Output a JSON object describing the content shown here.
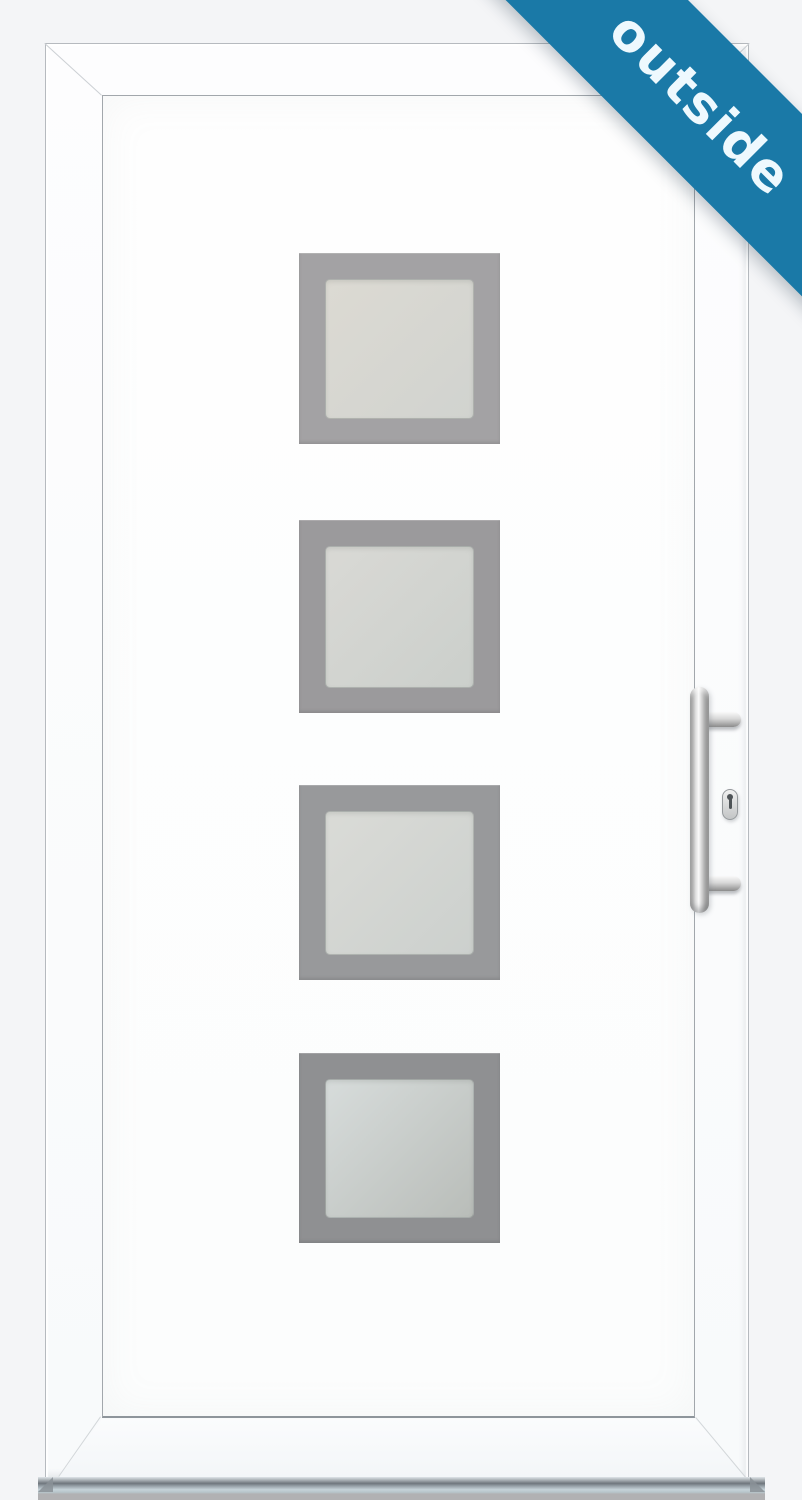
{
  "scene": {
    "background_color": "#f4f5f7"
  },
  "ribbon": {
    "label": "outside",
    "background_color": "#1a79a7",
    "text_color": "#eef9fe"
  },
  "door": {
    "frame_color": "#fdfdfe",
    "leaf_color": "#fefefe",
    "edge_line_color": "#a2a7ac",
    "panels": [
      {
        "name": "glass-panel-1",
        "frame_color": "#a3a2a4",
        "glass_top": "#dcdad3",
        "glass_bottom": "#d1d3cf"
      },
      {
        "name": "glass-panel-2",
        "frame_color": "#9b9a9c",
        "glass_top": "#d9d9d5",
        "glass_bottom": "#cbcfcb"
      },
      {
        "name": "glass-panel-3",
        "frame_color": "#98999b",
        "glass_top": "#dadbd7",
        "glass_bottom": "#ccd0cd"
      },
      {
        "name": "glass-panel-4",
        "frame_color": "#8f9092",
        "glass_top": "#d7dcdb",
        "glass_bottom": "#b9bdb9"
      }
    ],
    "hardware": {
      "handle_light": "#fafafa",
      "handle_dark": "#8b8b8b",
      "lock_face": "#c3c5c6",
      "keyhole_color": "#4e5357"
    },
    "threshold": {
      "profile_dark": "#6f767d",
      "profile_light": "#c6d3d9",
      "base_color": "#b1b1b3"
    }
  }
}
